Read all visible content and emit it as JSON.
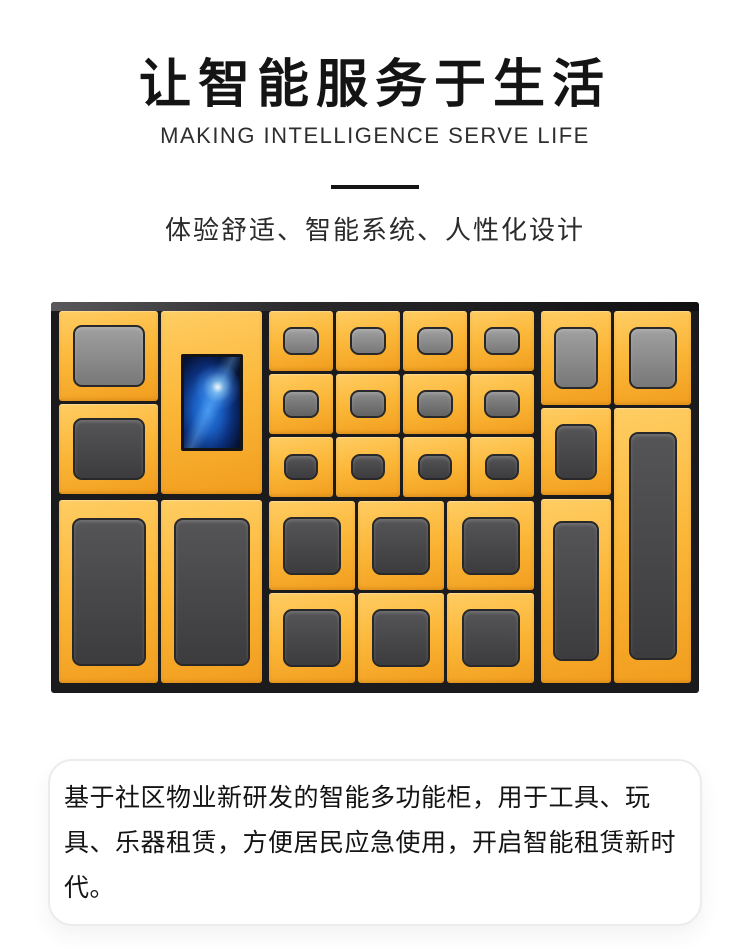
{
  "header": {
    "title": "让智能服务于生活",
    "subtitle": "MAKING INTELLIGENCE SERVE LIFE",
    "tagline": "体验舒适、智能系统、人性化设计"
  },
  "description": {
    "text": "基于社区物业新研发的智能多功能柜，用于工具、玩具、乐器租赁，方便居民应急使用，开启智能租赁新时代。"
  },
  "colors": {
    "door_yellow_light": "#ffcd63",
    "door_yellow": "#fbb637",
    "door_yellow_deep": "#f19d1e",
    "cabinet_frame": "#1b1b1d",
    "screen_blue": "#2f86e8",
    "screen_navy": "#030c24",
    "window_gray_light": "#a0a0a0",
    "window_gray_dark": "#3c3c3e",
    "text_ink": "#141414"
  },
  "cabinet_figure": {
    "inner_width": 632,
    "inner_height": 372,
    "doors": [
      {
        "x": 0,
        "y": 0,
        "w": 99,
        "h": 90,
        "win": "light",
        "ww": 72,
        "wh": 62
      },
      {
        "x": 0,
        "y": 93,
        "w": 99,
        "h": 90,
        "win": "dark",
        "ww": 72,
        "wh": 62
      },
      {
        "x": 0,
        "y": 189,
        "w": 99,
        "h": 183,
        "win": "dark",
        "ww": 74,
        "wh": 148
      },
      {
        "x": 102,
        "y": 0,
        "w": 101,
        "h": 183,
        "screen": true,
        "ww": 62,
        "wh": 97
      },
      {
        "x": 102,
        "y": 189,
        "w": 101,
        "h": 183,
        "win": "dark",
        "ww": 76,
        "wh": 148
      },
      {
        "x": 210,
        "y": 0,
        "w": 64,
        "h": 60,
        "win": "light",
        "ww": 36,
        "wh": 28
      },
      {
        "x": 277,
        "y": 0,
        "w": 64,
        "h": 60,
        "win": "light",
        "ww": 36,
        "wh": 28
      },
      {
        "x": 344,
        "y": 0,
        "w": 64,
        "h": 60,
        "win": "light",
        "ww": 36,
        "wh": 28
      },
      {
        "x": 411,
        "y": 0,
        "w": 64,
        "h": 60,
        "win": "light",
        "ww": 36,
        "wh": 28
      },
      {
        "x": 210,
        "y": 63,
        "w": 64,
        "h": 60,
        "win": "mid",
        "ww": 36,
        "wh": 28
      },
      {
        "x": 277,
        "y": 63,
        "w": 64,
        "h": 60,
        "win": "mid",
        "ww": 36,
        "wh": 28
      },
      {
        "x": 344,
        "y": 63,
        "w": 64,
        "h": 60,
        "win": "mid",
        "ww": 36,
        "wh": 28
      },
      {
        "x": 411,
        "y": 63,
        "w": 64,
        "h": 60,
        "win": "mid",
        "ww": 36,
        "wh": 28
      },
      {
        "x": 210,
        "y": 126,
        "w": 64,
        "h": 60,
        "win": "dark",
        "ww": 34,
        "wh": 26
      },
      {
        "x": 277,
        "y": 126,
        "w": 64,
        "h": 60,
        "win": "dark",
        "ww": 34,
        "wh": 26
      },
      {
        "x": 344,
        "y": 126,
        "w": 64,
        "h": 60,
        "win": "dark",
        "ww": 34,
        "wh": 26
      },
      {
        "x": 411,
        "y": 126,
        "w": 64,
        "h": 60,
        "win": "dark",
        "ww": 34,
        "wh": 26
      },
      {
        "x": 210,
        "y": 190,
        "w": 86,
        "h": 89,
        "win": "dark",
        "ww": 58,
        "wh": 58
      },
      {
        "x": 299,
        "y": 190,
        "w": 86,
        "h": 89,
        "win": "dark",
        "ww": 58,
        "wh": 58
      },
      {
        "x": 388,
        "y": 190,
        "w": 87,
        "h": 89,
        "win": "dark",
        "ww": 58,
        "wh": 58
      },
      {
        "x": 210,
        "y": 282,
        "w": 86,
        "h": 90,
        "win": "dark",
        "ww": 58,
        "wh": 58
      },
      {
        "x": 299,
        "y": 282,
        "w": 86,
        "h": 90,
        "win": "dark",
        "ww": 58,
        "wh": 58
      },
      {
        "x": 388,
        "y": 282,
        "w": 87,
        "h": 90,
        "win": "dark",
        "ww": 58,
        "wh": 58
      },
      {
        "x": 482,
        "y": 0,
        "w": 70,
        "h": 94,
        "win": "light",
        "ww": 44,
        "wh": 62
      },
      {
        "x": 482,
        "y": 97,
        "w": 70,
        "h": 87,
        "win": "dark",
        "ww": 42,
        "wh": 56
      },
      {
        "x": 482,
        "y": 188,
        "w": 70,
        "h": 184,
        "win": "dark",
        "ww": 46,
        "wh": 140
      },
      {
        "x": 555,
        "y": 0,
        "w": 77,
        "h": 94,
        "win": "light",
        "ww": 48,
        "wh": 62
      },
      {
        "x": 555,
        "y": 97,
        "w": 77,
        "h": 275,
        "win": "dark",
        "ww": 48,
        "wh": 228
      }
    ]
  }
}
